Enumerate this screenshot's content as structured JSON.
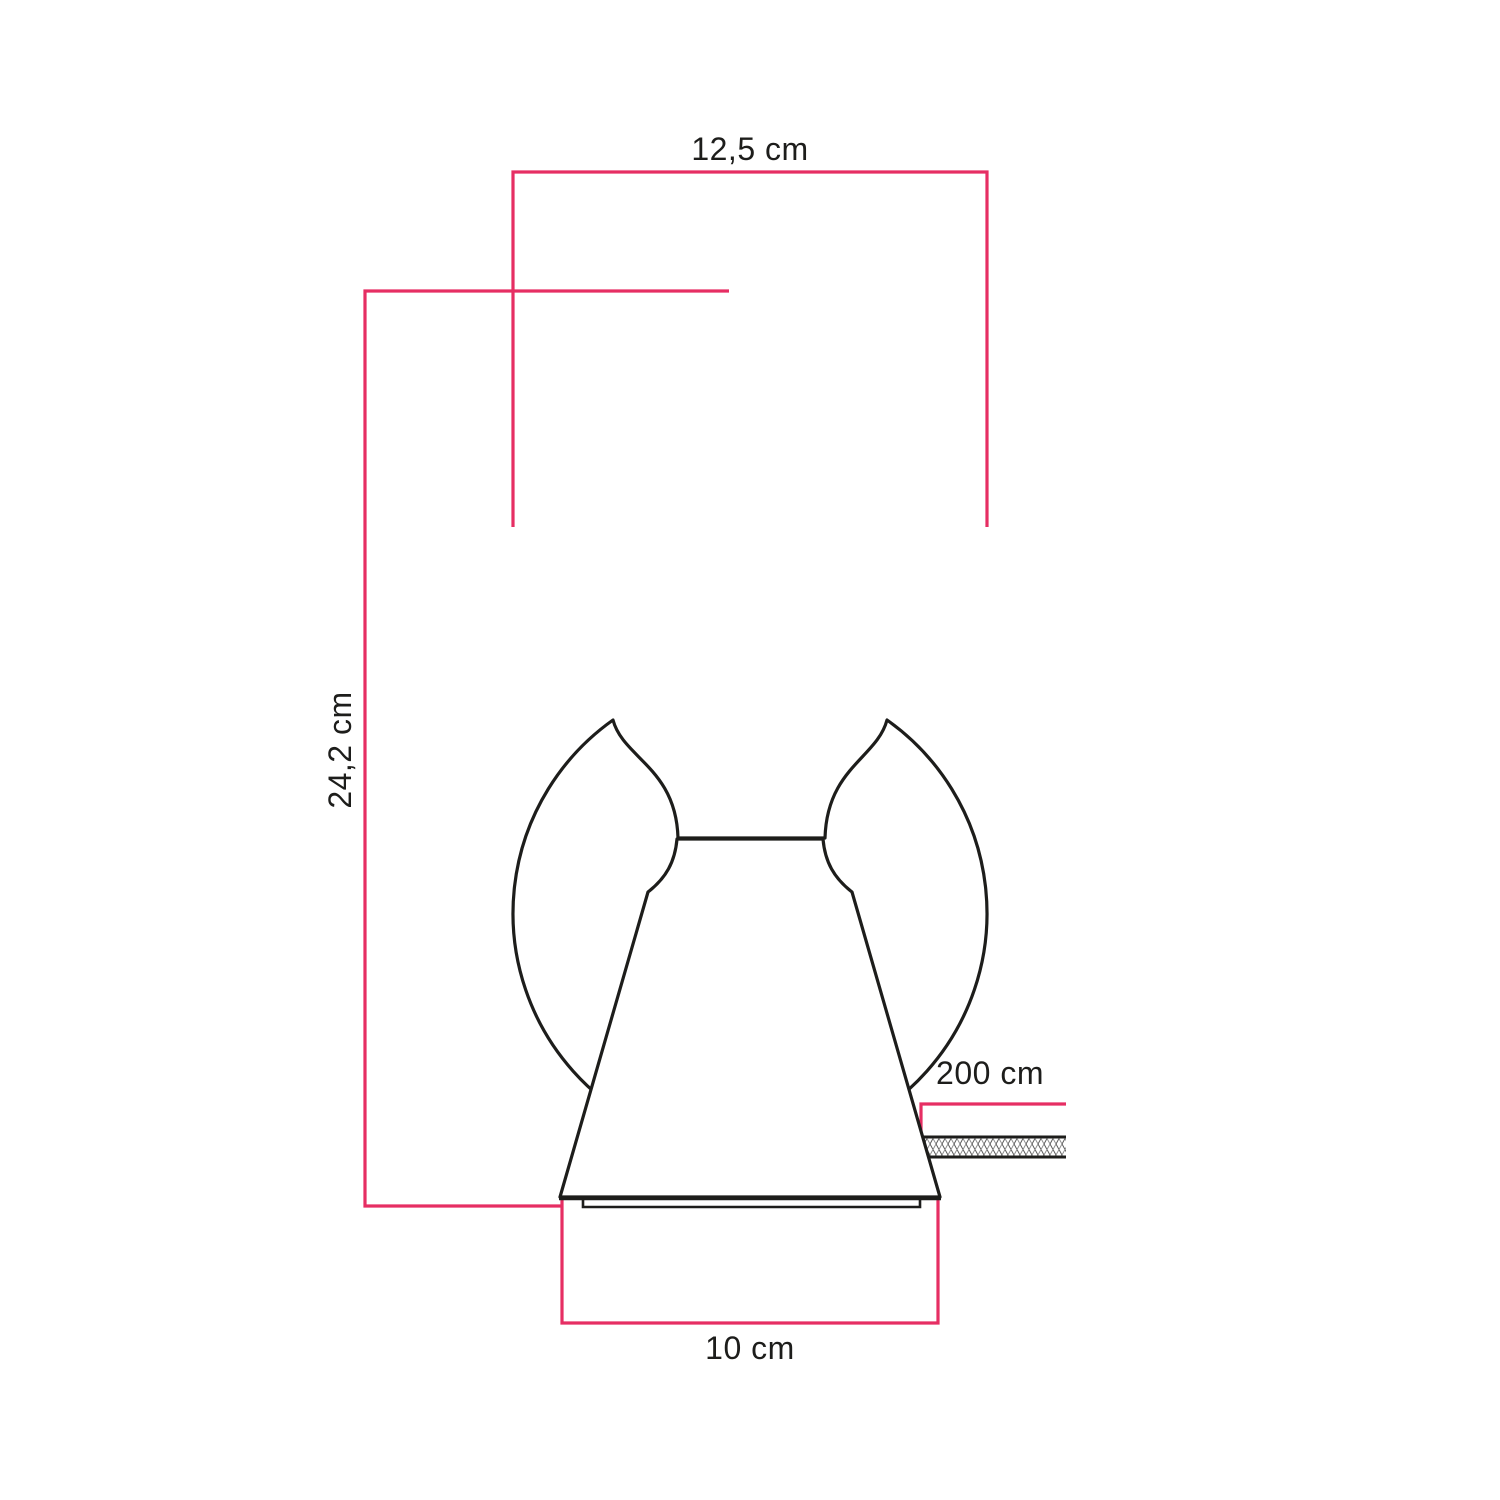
{
  "diagram": {
    "kind": "product-dimension-drawing",
    "subject": "table lamp with cone base and globe bulb",
    "dimensions": {
      "bulb_diameter": {
        "label": "12,5 cm"
      },
      "total_height": {
        "label": "24,2 cm"
      },
      "cable_length": {
        "label": "200 cm"
      },
      "base_diameter": {
        "label": "10 cm"
      }
    },
    "colors": {
      "dimension_line": "#e62e63",
      "outline": "#1d1d1b",
      "background": "#ffffff"
    }
  }
}
